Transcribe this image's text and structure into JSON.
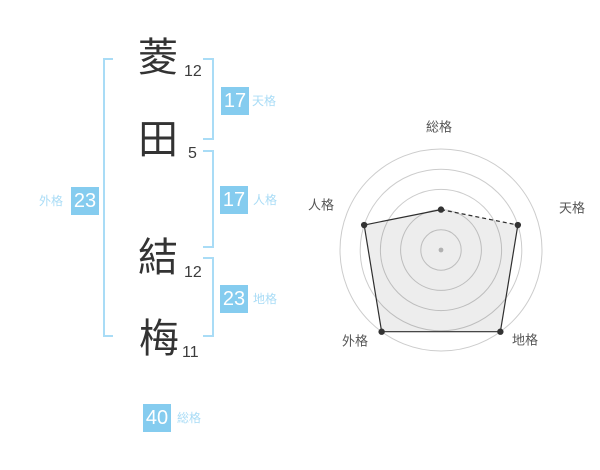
{
  "page": {
    "background": "#ffffff"
  },
  "colors": {
    "accent_badge": "#85ccef",
    "accent_line": "#a9dcf6",
    "accent_label": "#a9dcf6",
    "ink": "#333333",
    "grid": "#cccccc",
    "center_dot": "#bfbfbf",
    "polygon_line": "#2f2f2f",
    "polygon_fill": "rgba(0,0,0,0.07)",
    "polygon_point": "#333333",
    "radar_label": "#555555"
  },
  "name": {
    "characters": [
      {
        "char": "菱",
        "strokes": "12"
      },
      {
        "char": "田",
        "strokes": "5"
      },
      {
        "char": "結",
        "strokes": "12"
      },
      {
        "char": "梅",
        "strokes": "11"
      }
    ]
  },
  "scores": {
    "tenkaku": {
      "label": "天格",
      "value": "17"
    },
    "jinkaku": {
      "label": "人格",
      "value": "17"
    },
    "chikaku": {
      "label": "地格",
      "value": "23"
    },
    "gaikaku": {
      "label": "外格",
      "value": "23"
    },
    "soukaku": {
      "label": "総格",
      "value": "40"
    }
  },
  "chart_data": {
    "type": "radar",
    "axes": [
      "総格",
      "天格",
      "地格",
      "外格",
      "人格"
    ],
    "values": [
      2,
      4,
      5,
      5,
      4
    ],
    "max": 5,
    "rings": 5,
    "grid": "circular-rings-no-spokes",
    "legend": false,
    "axis_scores": {
      "総格": 40,
      "天格": 17,
      "地格": 23,
      "外格": 23,
      "人格": 17
    },
    "label_offsets": [
      [
        -2,
        -123
      ],
      [
        131,
        -42
      ],
      [
        84,
        90
      ],
      [
        -86,
        91
      ],
      [
        -120,
        -45
      ]
    ],
    "dashed_edges": [
      0
    ]
  }
}
